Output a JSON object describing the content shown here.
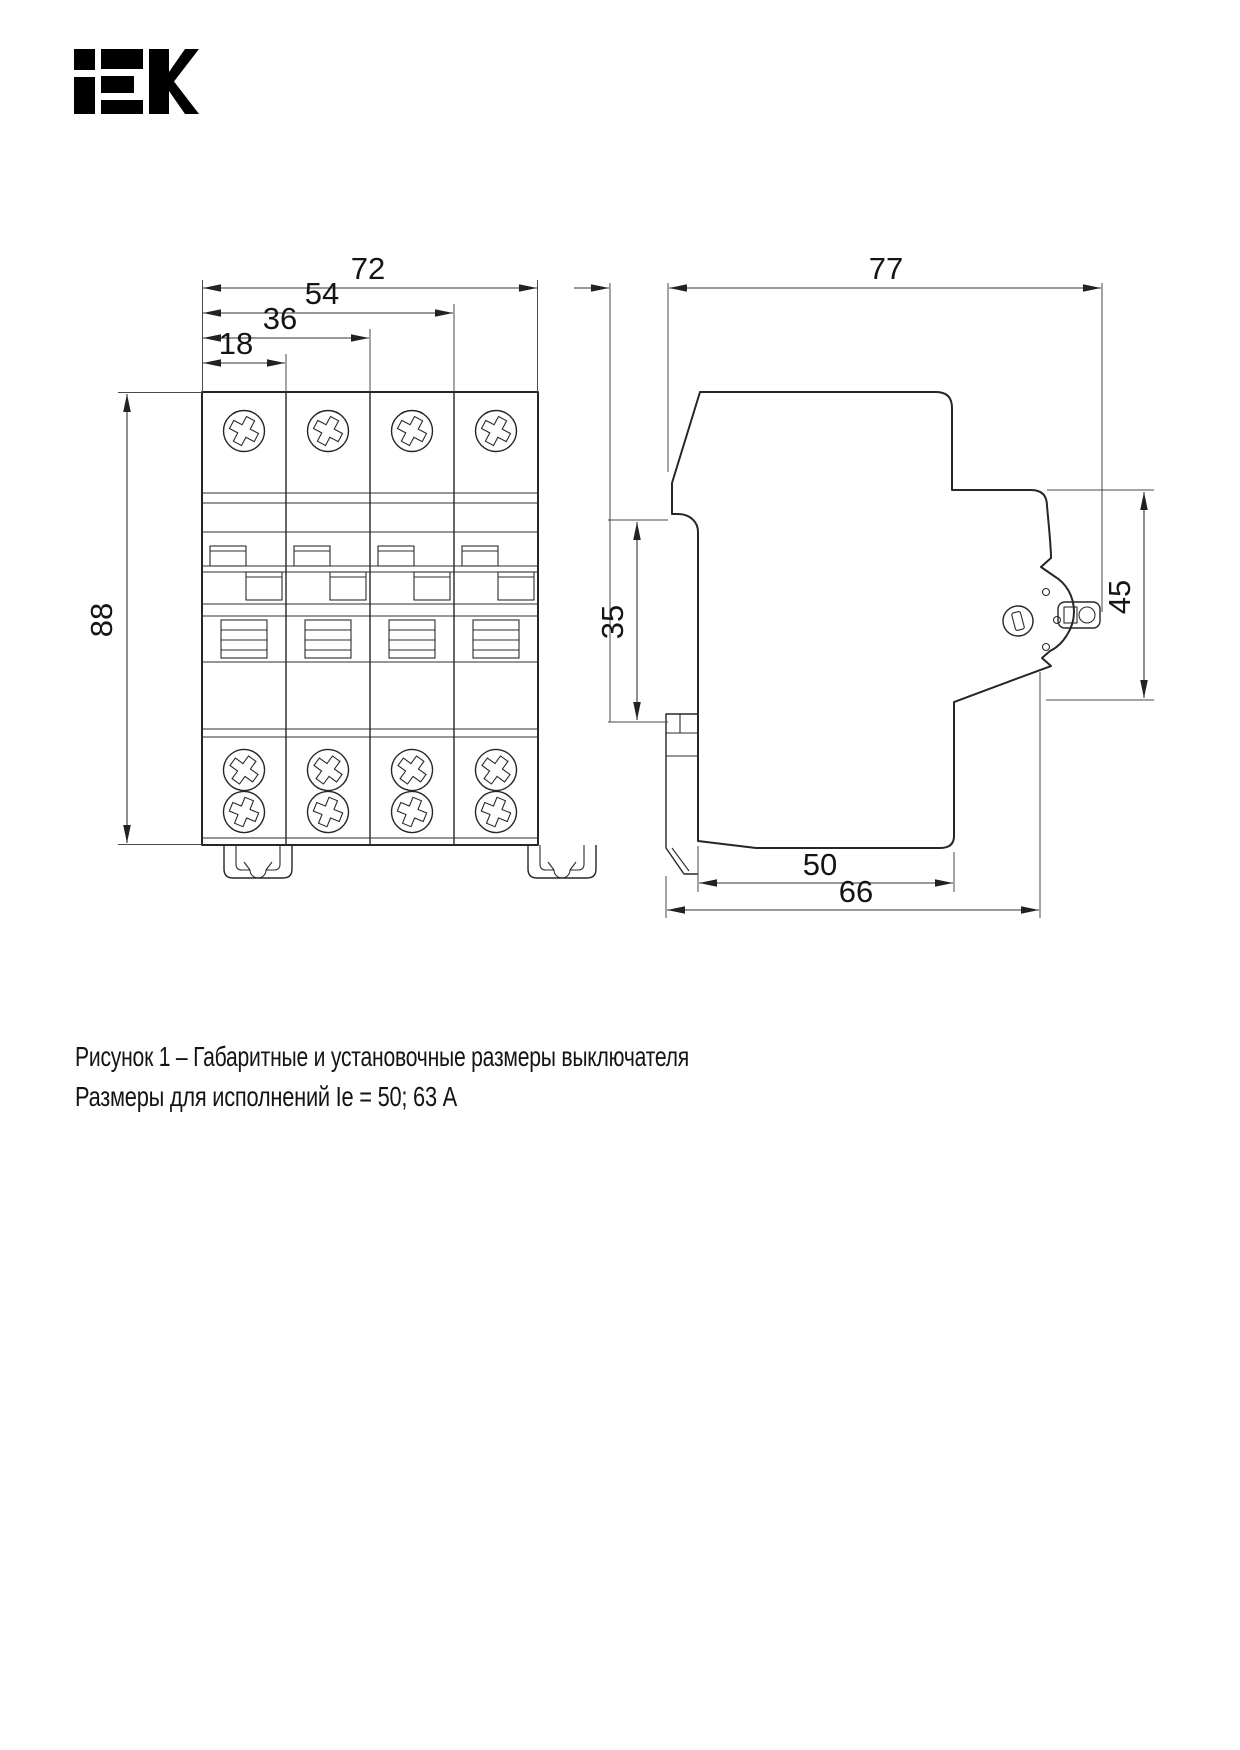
{
  "logo": {
    "brand": "IEK"
  },
  "front_view": {
    "dim_width_total": "72",
    "dim_width_3mod": "54",
    "dim_width_2mod": "36",
    "dim_width_1mod": "18",
    "dim_height": "88"
  },
  "side_view": {
    "dim_depth_total": "77",
    "dim_din_rail": "35",
    "dim_front_height": "45",
    "dim_bottom_depth": "50",
    "dim_mount_depth": "66"
  },
  "caption": {
    "line1": "Рисунок 1 – Габаритные и установочные размеры выключателя",
    "line2": "Размеры для исполнений Ie = 50; 63 А"
  }
}
